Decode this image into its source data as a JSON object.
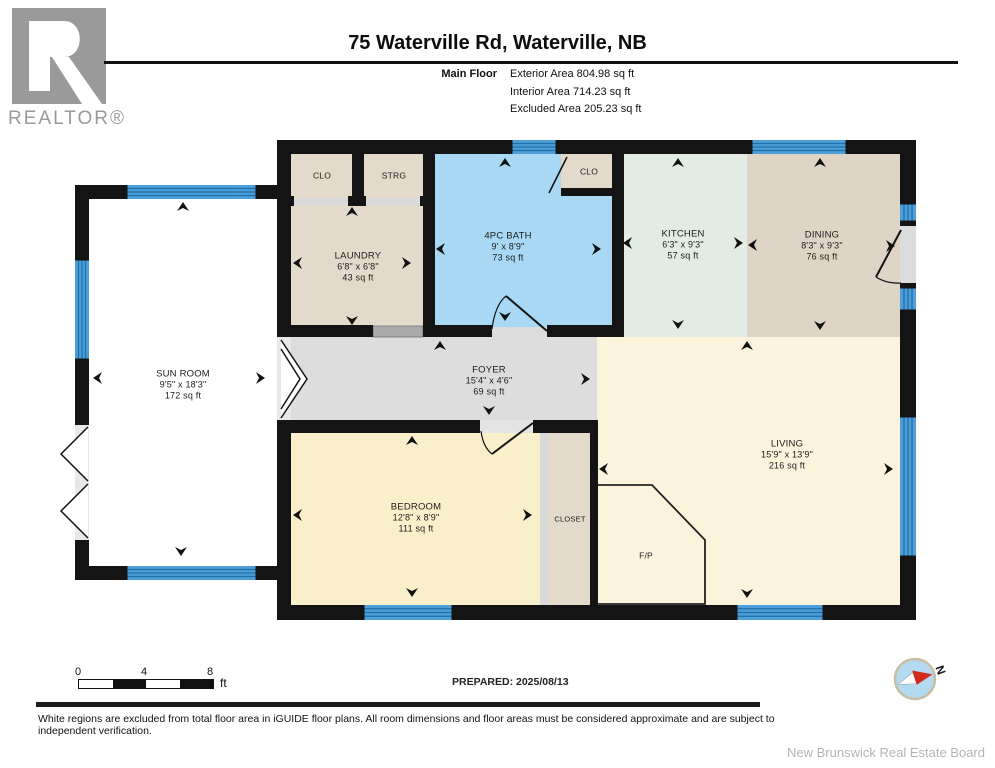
{
  "brand": {
    "logo_text": "REALTOR®"
  },
  "header": {
    "title": "75 Waterville Rd, Waterville, NB",
    "floor_label": "Main Floor",
    "stats": [
      "Exterior Area 804.98 sq ft",
      "Interior Area 714.23 sq ft",
      "Excluded Area 205.23 sq ft"
    ]
  },
  "rooms": {
    "sun_room": {
      "name": "SUN ROOM",
      "dims": "9'5\" x 18'3\"",
      "area": "172 sq ft"
    },
    "laundry": {
      "name": "LAUNDRY",
      "dims": "6'8\" x 6'8\"",
      "area": "43 sq ft"
    },
    "bath": {
      "name": "4PC BATH",
      "dims": "9' x 8'9\"",
      "area": "73 sq ft"
    },
    "kitchen": {
      "name": "KITCHEN",
      "dims": "6'3\" x 9'3\"",
      "area": "57 sq ft"
    },
    "dining": {
      "name": "DINING",
      "dims": "8'3\" x 9'3\"",
      "area": "76 sq ft"
    },
    "foyer": {
      "name": "FOYER",
      "dims": "15'4\" x 4'6\"",
      "area": "69 sq ft"
    },
    "living": {
      "name": "LIVING",
      "dims": "15'9\" x 13'9\"",
      "area": "216 sq ft"
    },
    "bedroom": {
      "name": "BEDROOM",
      "dims": "12'8\" x 8'9\"",
      "area": "111 sq ft"
    },
    "closet": {
      "name": "CLOSET"
    },
    "clo1": {
      "name": "CLO"
    },
    "strg": {
      "name": "STRG"
    },
    "clo2": {
      "name": "CLO"
    },
    "fireplace": {
      "name": "F/P"
    }
  },
  "footer": {
    "scale": {
      "ticks": [
        "0",
        "4",
        "8"
      ],
      "unit": "ft"
    },
    "prepared": "PREPARED: 2025/08/13",
    "compass_label": "N",
    "disclaimer": "White regions are excluded from total floor area in iGUIDE floor plans. All room dimensions and floor areas must be considered approximate and are subject to independent verification.",
    "attribution": "New Brunswick Real Estate Board"
  },
  "colors": {
    "wall": "#141414",
    "window_blue": "#4e9fd9",
    "window_stripe": "#1f6fa8",
    "bath_fill": "#a8d8f4",
    "kitchen_fill": "#e3ece4",
    "beige_fill": "#e3dacb",
    "dining_fill": "#dfd5c7",
    "living_fill": "#fbf3dc",
    "bedroom_fill": "#faefcb",
    "foyer_fill": "#dddddd",
    "compass_red": "#d42a1e",
    "logo_gray": "#9a9a9a"
  }
}
